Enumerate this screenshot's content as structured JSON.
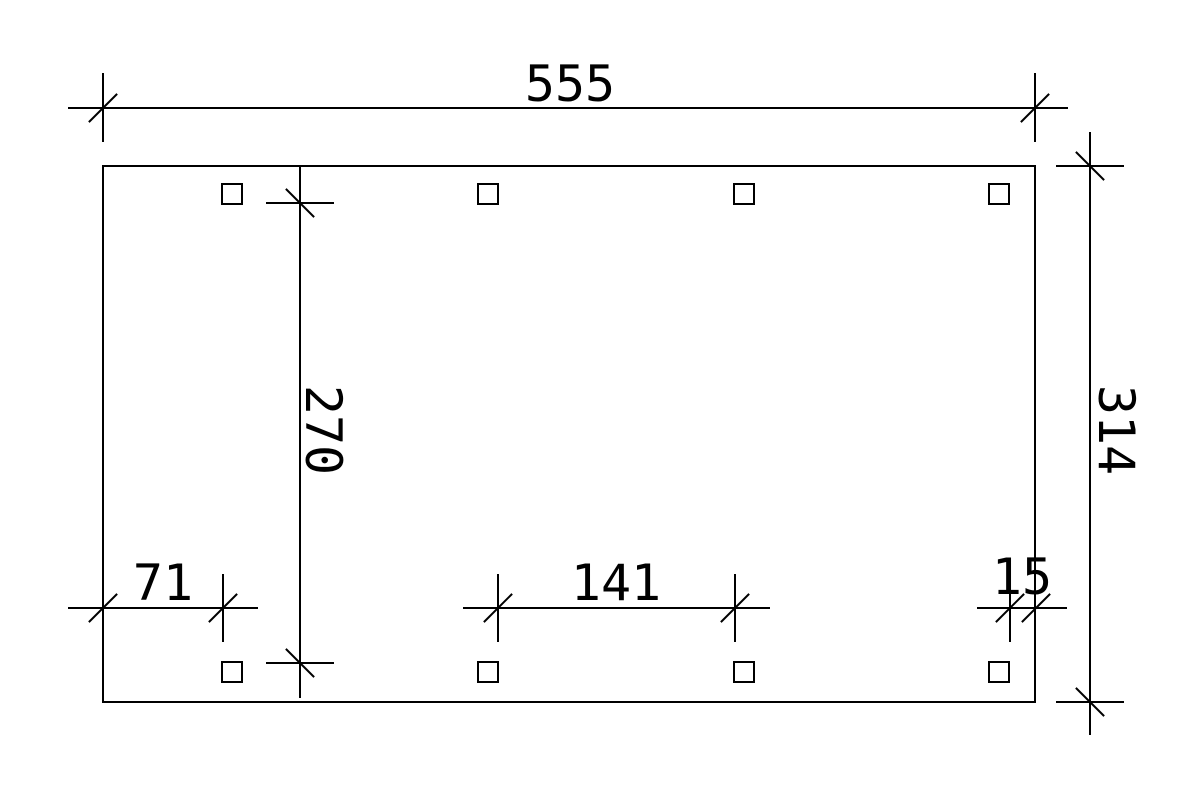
{
  "page": {
    "background_color": "#ffffff"
  },
  "drawing": {
    "type": "technical-dimension-plan",
    "line_color": "#000000",
    "frame": {
      "shape": "rectangle"
    },
    "posts": {
      "marker_shape": "square",
      "top_row_count": 4,
      "bottom_row_count": 4
    },
    "labels": {
      "top_width": "555",
      "right_height": "314",
      "inner_height": "270",
      "bottom_left": "71",
      "bottom_middle": "141",
      "bottom_right": "15"
    }
  }
}
